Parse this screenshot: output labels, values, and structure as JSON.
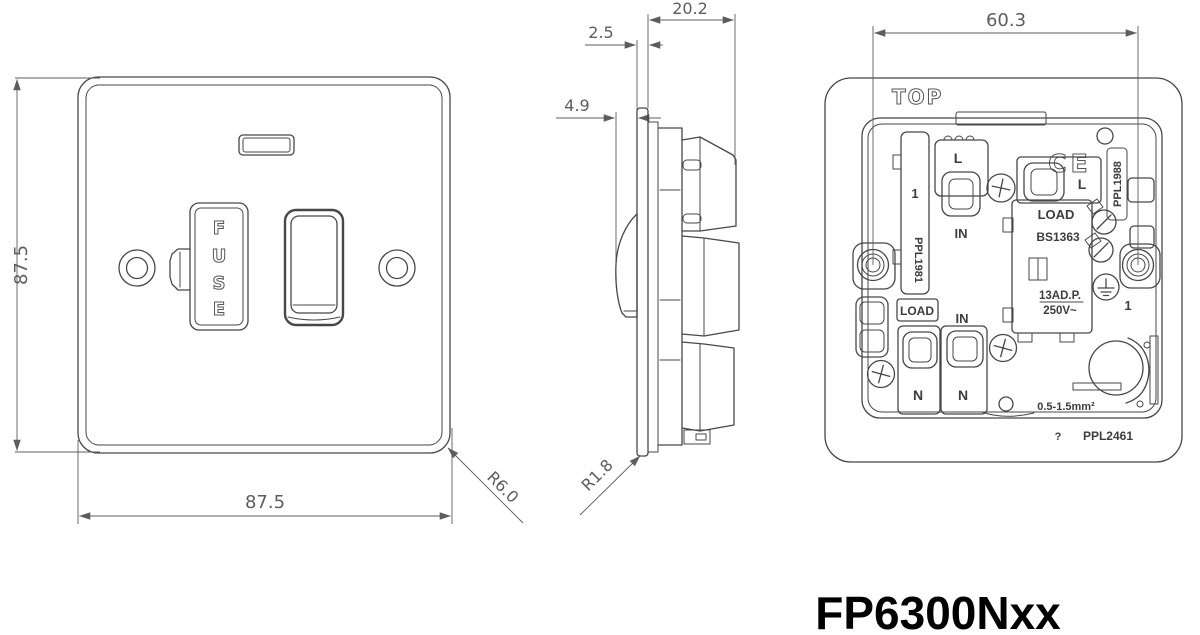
{
  "colors": {
    "background": "#ffffff",
    "line": "#474747",
    "dimension": "#5d5d5d",
    "label": "#3d3d3d",
    "model_text": "#000000"
  },
  "model": "FP6300Nxx",
  "front_view": {
    "dim_height": "87.5",
    "dim_width": "87.5",
    "corner_radius": "R6.0",
    "fuse_letters": [
      "F",
      "U",
      "S",
      "E"
    ]
  },
  "side_view": {
    "dim_depth": "20.2",
    "dim_plate_thickness": "2.5",
    "dim_switch_protrusion": "4.9",
    "corner_radius": "R1.8"
  },
  "rear_view": {
    "dim_fixing_centres": "60.3",
    "orientation_label": "TOP",
    "ce_mark": "CE",
    "live_terminal_1": "L",
    "live_terminal_2": "L",
    "in_label_top": "IN",
    "in_label_bottom": "IN",
    "neutral_terminal_1": "N",
    "neutral_terminal_2": "N",
    "load_label_left": "LOAD",
    "load_label_fuse": "LOAD",
    "fuse_standard": "BS1363",
    "rating_line1": "13AD.P.",
    "rating_line2": "250V~",
    "wire_capacity": "0.5-1.5mm²",
    "part_number_left": "PPL1981",
    "part_number_right": "PPL1988",
    "part_number_bottom": "PPL2461",
    "hole_marker_left": "1",
    "hole_marker_right": "1",
    "manufacturer_mark": "?"
  }
}
